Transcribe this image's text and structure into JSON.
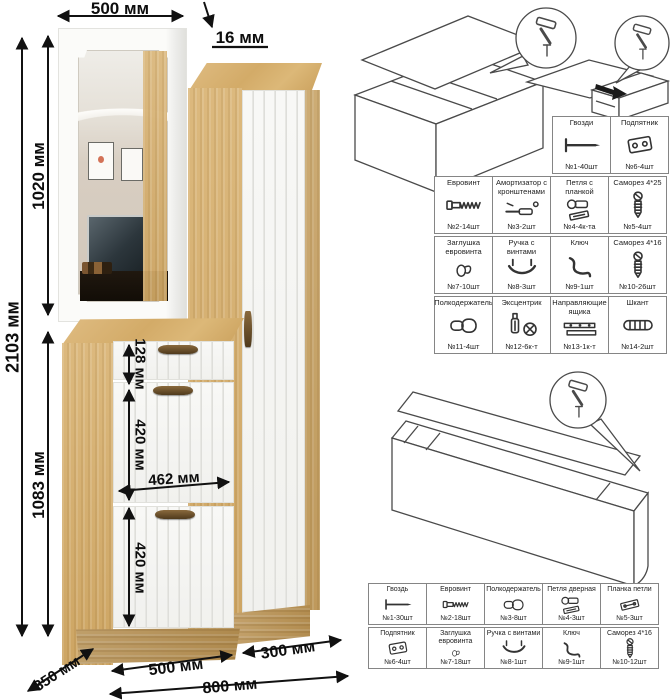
{
  "dimensions": {
    "top_width": "500 мм",
    "panel_thickness": "16 мм",
    "total_height": "2103 мм",
    "upper_section_height": "1020 мм",
    "lower_section_height": "1083 мм",
    "drawer_front_height": "128 мм",
    "upper_door_height": "420 мм",
    "inner_width": "462 мм",
    "lower_door_height": "420 мм",
    "depth": "350 мм",
    "left_module_width": "500 мм",
    "right_module_width": "300 мм",
    "total_width": "800 мм"
  },
  "hardware_table_upper": {
    "rows": [
      {
        "cells": [
          {
            "name": "Гвозди",
            "count": "№1-40шт",
            "icon": "nail-icon"
          },
          {
            "name": "Подпятник",
            "count": "№6-4шт",
            "icon": "foot-plate-icon"
          }
        ]
      },
      {
        "cells": [
          {
            "name": "Евровинт",
            "count": "№2-14шт",
            "icon": "confirmat-screw-icon"
          },
          {
            "name": "Амортизатор с кронштенами",
            "count": "№3-2шт",
            "icon": "gas-lift-icon"
          },
          {
            "name": "Петля с планкой",
            "count": "№4-4к-та",
            "icon": "hinge-icon"
          },
          {
            "name": "Саморез 4*25",
            "count": "№5-4шт",
            "icon": "screw-icon"
          }
        ]
      },
      {
        "cells": [
          {
            "name": "Заглушка евровинта",
            "count": "№7-10шт",
            "icon": "cap-icon"
          },
          {
            "name": "Ручка с винтами",
            "count": "№8-3шт",
            "icon": "handle-icon"
          },
          {
            "name": "Ключ",
            "count": "№9-1шт",
            "icon": "hex-key-icon"
          },
          {
            "name": "Саморез 4*16",
            "count": "№10-26шт",
            "icon": "screw-icon"
          }
        ]
      },
      {
        "cells": [
          {
            "name": "Полкодержатель",
            "count": "№11-4шт",
            "icon": "shelf-pin-icon"
          },
          {
            "name": "Эксцентрик",
            "count": "№12-6к-т",
            "icon": "cam-lock-icon"
          },
          {
            "name": "Направляющие ящика",
            "count": "№13-1к-т",
            "icon": "drawer-slides-icon"
          },
          {
            "name": "Шкант",
            "count": "№14-2шт",
            "icon": "dowel-icon"
          }
        ]
      }
    ]
  },
  "hardware_table_lower": {
    "rows": [
      {
        "cells": [
          {
            "name": "Гвоздь",
            "count": "№1-30шт",
            "icon": "nail-icon"
          },
          {
            "name": "Евровинт",
            "count": "№2-18шт",
            "icon": "confirmat-screw-icon"
          },
          {
            "name": "Полкодержатель",
            "count": "№3-8шт",
            "icon": "shelf-pin-icon"
          },
          {
            "name": "Петля дверная",
            "count": "№4-3шт",
            "icon": "hinge-icon"
          },
          {
            "name": "Планка петли",
            "count": "№5-3шт",
            "icon": "hinge-plate-icon"
          }
        ]
      },
      {
        "cells": [
          {
            "name": "Подпятник",
            "count": "№6-4шт",
            "icon": "foot-plate-icon"
          },
          {
            "name": "Заглушка евровинта",
            "count": "№7-18шт",
            "icon": "cap-icon"
          },
          {
            "name": "Ручка с винтами",
            "count": "№8-1шт",
            "icon": "handle-icon"
          },
          {
            "name": "Ключ",
            "count": "№9-1шт",
            "icon": "hex-key-icon"
          },
          {
            "name": "Саморез 4*16",
            "count": "№10-12шт",
            "icon": "screw-icon"
          }
        ]
      }
    ]
  },
  "colors": {
    "wood": "#d7b277",
    "wood_dark": "#c39a58",
    "front_white": "#f7f7f4",
    "diagram_line": "#4a4a4a",
    "dimension_line": "#111111",
    "handle_bronze": "#6e4f28"
  }
}
